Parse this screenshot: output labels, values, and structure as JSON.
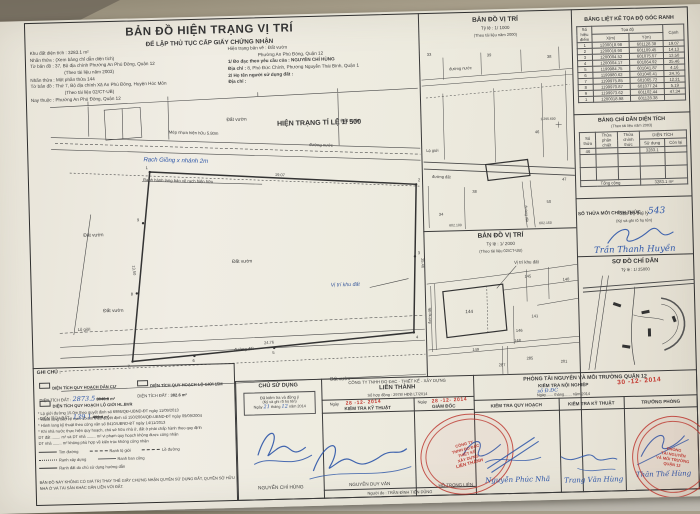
{
  "corner_note": "267621 CN4",
  "header": {
    "title": "BẢN ĐỒ HIỆN TRẠNG VỊ TRÍ",
    "subtitle": "ĐỂ LẬP THỦ TỤC CẤP GIẤY CHỨNG NHẬN"
  },
  "info": {
    "left": [
      {
        "label": "Khu đất diện tích :",
        "value": "3283.1 m²"
      },
      {
        "label": "Nhãn thửa :",
        "value": "(Xem bảng chỉ dẫn diện tích)"
      },
      {
        "label": "Tờ bản đồ :",
        "value": "37, Bộ địa chính Phường An Phú Đông, Quận 12"
      },
      {
        "label": "",
        "value": "(Theo tài liệu năm 2003)"
      },
      {
        "label": "Nhãn thửa :",
        "value": "Một phần thửa 144"
      },
      {
        "label": "Tờ bản đồ :",
        "value": "Thứ 7, Bộ địa chính Xã An Phú Đông, Huyện Hóc Môn"
      },
      {
        "label": "",
        "value": "(Theo tài liệu 02/CT-UB)"
      },
      {
        "label": "Nay thuộc :",
        "value": "Phường An Phú Đông, Quận 12"
      }
    ],
    "right": [
      {
        "label": "Hiện trạng bản vẽ :",
        "value": "Đất vườn"
      },
      {
        "label": "",
        "value": "Phường An Phú Đông, Quận 12"
      },
      {
        "label": "1/ Đo đạc theo yêu cầu của :",
        "value": "NGUYỄN CHÍ HÙNG"
      },
      {
        "label": "Địa chỉ :",
        "value": "8, Phó Đức Chính, Phường Nguyễn Thái Bình, Quận 1"
      },
      {
        "label": "2/ Họ tên người sử dụng đất :",
        "value": ""
      },
      {
        "label": "Địa chỉ :",
        "value": ""
      }
    ]
  },
  "main_map": {
    "title": "HIỆN TRẠNG TỈ LỆ 1/ 500",
    "labels": {
      "dat_vuon": "Đất vườn",
      "mep_nhua": "Mép nhựa hiện hữu 5.80m",
      "duong_nuoc": "đường nước",
      "rach_hw": "Rạch Giồng x nhánh 2m",
      "ranh_hl": "Ranh hành lang bảo vệ rạch hiện hữu",
      "lo_gioi": "Lộ giới",
      "duong_dat": "đường đất",
      "vi_tri": "Vị trí khu đất"
    },
    "edges": [
      "19.07",
      "25.46",
      "24.76",
      "13.50"
    ],
    "points": [
      "1",
      "2",
      "3",
      "4",
      "5",
      "6",
      "7",
      "8",
      "9"
    ]
  },
  "map1000": {
    "title": "BẢN ĐỒ VỊ TRÍ",
    "scale": "Tỷ lệ : 1/ 1000",
    "source": "(Theo tài liệu năm 2000)",
    "duong_nuoc": "đường nước",
    "lo_gioi": "Lộ giới",
    "duong_dat": "đường đất",
    "parcels": [
      "33",
      "39",
      "38",
      "46",
      "47",
      "38",
      "34",
      "50"
    ],
    "grid": "1.295.600",
    "sheet1": "602.100",
    "sheet2": "602.150"
  },
  "map2000": {
    "title": "BẢN ĐỒ VỊ TRÍ",
    "scale": "Tỷ lệ : 1/ 2000",
    "source": "(Theo tài liệu 02/CT-UB)",
    "vi_tri": "Vị trí khu đất",
    "duong_dat": "đường đất",
    "parcels": [
      "144",
      "145",
      "140",
      "141",
      "146",
      "148",
      "149",
      "287",
      "285",
      "201"
    ]
  },
  "coord_table": {
    "title": "BẢNG LIỆT KÊ TỌA ĐỘ GÓC RANH",
    "col_point": "Số hiệu điểm",
    "col_coord": "Tọa độ",
    "col_x": "X(m)",
    "col_y": "Y(m)",
    "col_edge": "Cạnh",
    "rows": [
      {
        "p": "1",
        "x": "1200018.98",
        "y": "601128.38",
        "c": "19.07"
      },
      {
        "p": "2",
        "x": "1200019.90",
        "y": "601109.45",
        "c": "14.13"
      },
      {
        "p": "3",
        "x": "1200004.52",
        "y": "601075.57",
        "c": "13.50"
      },
      {
        "p": "4",
        "x": "1200004.17",
        "y": "601064.92",
        "c": "25.46"
      },
      {
        "p": "5",
        "x": "1199984.75",
        "y": "601041.87",
        "c": "4.16"
      },
      {
        "p": "6",
        "x": "1199980.62",
        "y": "601040.41",
        "c": "24.76"
      },
      {
        "p": "7",
        "x": "1199975.85",
        "y": "601065.72",
        "c": "12.21"
      },
      {
        "p": "8",
        "x": "1199970.87",
        "y": "601077.24",
        "c": "5.19"
      },
      {
        "p": "9",
        "x": "1199973.62",
        "y": "601102.44",
        "c": "47.34"
      },
      {
        "p": "1",
        "x": "1200018.98",
        "y": "601128.38",
        "c": ""
      }
    ]
  },
  "area_table": {
    "title": "BẢNG CHỈ DẪN DIỆN TÍCH",
    "source": "(Theo tài liệu năm 2003)",
    "col_so_thua": "Số thửa",
    "col_phan_chiet": "Thửa phân chiết",
    "col_chinh_thuc": "Thửa chính thức",
    "col_dien_tich": "DIỆN TÍCH",
    "col_su_dung": "Sử dụng",
    "col_con_lai": "Còn lại",
    "row": {
      "so_thua": "46",
      "su_dung": "3283.1"
    },
    "footer_label": "Tổng cộng",
    "footer_value": "3283.1 m²"
  },
  "new_parcel": {
    "label": "SỐ THỬA MỚI CHÍNH THỨC :",
    "number_hw": "543",
    "staff": "Cán bộ thụ lý",
    "note": "(Ký và ghi rõ họ tên)",
    "signature_name": "Trần Thanh Huyền"
  },
  "so_do": {
    "title": "SƠ ĐỒ CHỈ DẪN",
    "scale": "Tỷ lệ : 1/ 25000"
  },
  "ghi_chu": {
    "title": "GHI CHÚ :",
    "items": [
      {
        "label": "DIỆN TÍCH QUY HOẠCH DÂN CƯ",
        "sub": "DIỆN TÍCH ĐẤT :",
        "hw": "2873.5",
        "struck": "3046.6",
        "unit": "m²"
      },
      {
        "label": "DIỆN TÍCH QUY HOẠCH LỘ GIỚI 15M",
        "sub": "DIỆN TÍCH ĐẤT :",
        "value": "382.6",
        "unit": "m²"
      },
      {
        "label": "DIỆN TÍCH QUY HOẠCH LỘ GIỚI HL.BVR",
        "sub": "DIỆN TÍCH ĐẤT :",
        "hw": "139.1",
        "struck": "499.4",
        "unit": "m²"
      }
    ],
    "notes": [
      "* Lộ giới đường 15.0m theo quyết định số 6986/QĐ-UBND-ĐT ngày 11/09/2013",
      "* Hành lang bảo vệ rạch 10.0m theo quyết định số 150/2004/QĐ-UBND-ĐT ngày 09/09/2004",
      "* Hành lang kỹ thuật theo công văn số 8410/UBND-ĐT ngày 14/11/2013",
      "* Khi nhà nước thực hiện quy hoạch, chủ sở hữu nhà ở, đất ở phải chấp hành theo quy định",
      "DT đất ........ m² và DT nhà ........ m² vi phạm quy hoạch không được công nhận",
      "DT nhà ........ m² không phù hợp về kiến trúc không công nhận"
    ],
    "legend": [
      {
        "label": "Tim đường"
      },
      {
        "label": "Ranh lộ giới"
      },
      {
        "label": "Lề đường"
      },
      {
        "label": "Ranh xây dựng"
      },
      {
        "label": "Ranh ban công"
      },
      {
        "label": "Ranh đất do chủ sử dụng hướng dẫn"
      }
    ],
    "footer": "BẢN ĐỒ NÀY KHÔNG CÓ GIÁ TRỊ THAY THẾ GIẤY CHỨNG NHẬN QUYỀN SỬ DỤNG ĐẤT, QUYỀN SỞ HỮU NHÀ Ở VÀ TÀI SẢN KHÁC GẮN LIỀN VỚI ĐẤT."
  },
  "signatures": {
    "chu_su_dung": {
      "title": "CHỦ SỬ DỤNG",
      "line1": "Đã kiểm tra và đồng ý",
      "line2": "(Ký và ghi rõ họ tên)",
      "date_pre": "Ngày",
      "day_hw": "21",
      "date_mid": "tháng",
      "month_hw": "12",
      "date_post": "năm 2014",
      "name": "NGUYỄN CHÍ HÙNG"
    },
    "company": {
      "name1": "CÔNG TY TNHH ĐO ĐẠC - THIẾT KẾ - XÂY DỰNG",
      "name2": "LIÊN THÀNH",
      "contract": "Số hợp đồng : 2978/ HĐĐ.LT/2014",
      "date_label": "Ngày",
      "date_stamp": "28 -12- 2014",
      "col1": "KIỂM TRA KỸ THUẬT",
      "col2": "GIÁM ĐỐC",
      "name_col1": "NGUYỄN DUY VÂN",
      "surveyor": "Người đo : TRẦN ĐÌNH TIẾN DŨNG",
      "name_col2": "HỒ TRỌNG LIÊN",
      "stamp_lines": [
        "CÔNG TY",
        "TNHH ĐO ĐẠC",
        "THIẾT KẾ",
        "XÂY DỰNG",
        "LIÊN THÀNH"
      ]
    },
    "phong": {
      "title": "PHÒNG TÀI NGUYÊN VÀ MÔI TRƯỜNG QUẬN 12",
      "sub": "KIỂM TRA NỘI NGHIỆP",
      "hw_note": "số Đ.ĐC",
      "date_line": "Ngày....... tháng....... năm 2014",
      "date_stamp": "30 -12- 2014",
      "col1": "KIỂM TRA QUY HOẠCH",
      "col2": "KIỂM TRA KỸ THUẬT",
      "col3": "TRƯỞNG PHÒNG",
      "name1": "Nguyễn Phúc Nhã",
      "name2": "Trang Văn Hùng",
      "name3": "Thân Thế Hùng",
      "stamp_lines": [
        "PHÒNG",
        "TÀI NGUYÊN",
        "VÀ MÔI TRƯỜNG",
        "QUẬN 12"
      ]
    }
  }
}
